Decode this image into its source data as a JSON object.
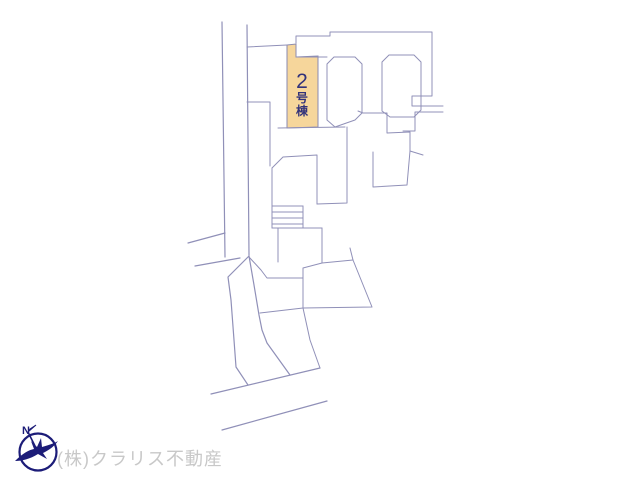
{
  "map": {
    "unit_label": {
      "number": "2",
      "suffix_char_1": "号",
      "suffix_char_2": "棟"
    },
    "compass": {
      "north_label": "N"
    },
    "watermark_text": "(株)クラリス不動産",
    "colors": {
      "highlight_fill": "#f6d69b",
      "highlight_outline": "#8b8bb0",
      "line": "#9090b8",
      "unit_text": "#32327a",
      "compass": "#1c1c78",
      "watermark": "#c8c8c8"
    }
  }
}
